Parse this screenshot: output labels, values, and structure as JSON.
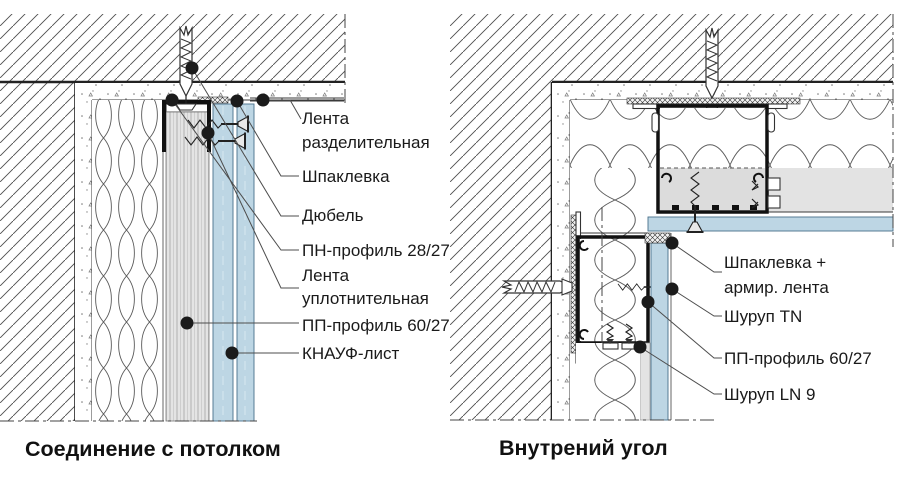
{
  "diagram": {
    "left": {
      "title": "Соединение с потолком",
      "labels": {
        "tape_divider_line1": "Лента",
        "tape_divider_line2": "разделительная",
        "putty": "Шпаклевка",
        "dowel": "Дюбель",
        "pn_profile": "ПН-профиль 28/27",
        "tape_sealing_line1": "Лента",
        "tape_sealing_line2": "уплотнительная",
        "pp_profile": "ПП-профиль 60/27",
        "knauf_sheet": "КНАУФ-лист"
      }
    },
    "right": {
      "title": "Внутрений угол",
      "labels": {
        "putty_tape_line1": "Шпаклевка +",
        "putty_tape_line2": "армир. лента",
        "screw_tn": "Шуруп TN",
        "pp_profile": "ПП-профиль 60/27",
        "screw_ln": "Шуруп LN 9"
      }
    },
    "colors": {
      "sheet_blue": "#bdd6e4",
      "layer_grey": "#e3e3e3",
      "channel_grey": "#dcdcdc"
    }
  }
}
